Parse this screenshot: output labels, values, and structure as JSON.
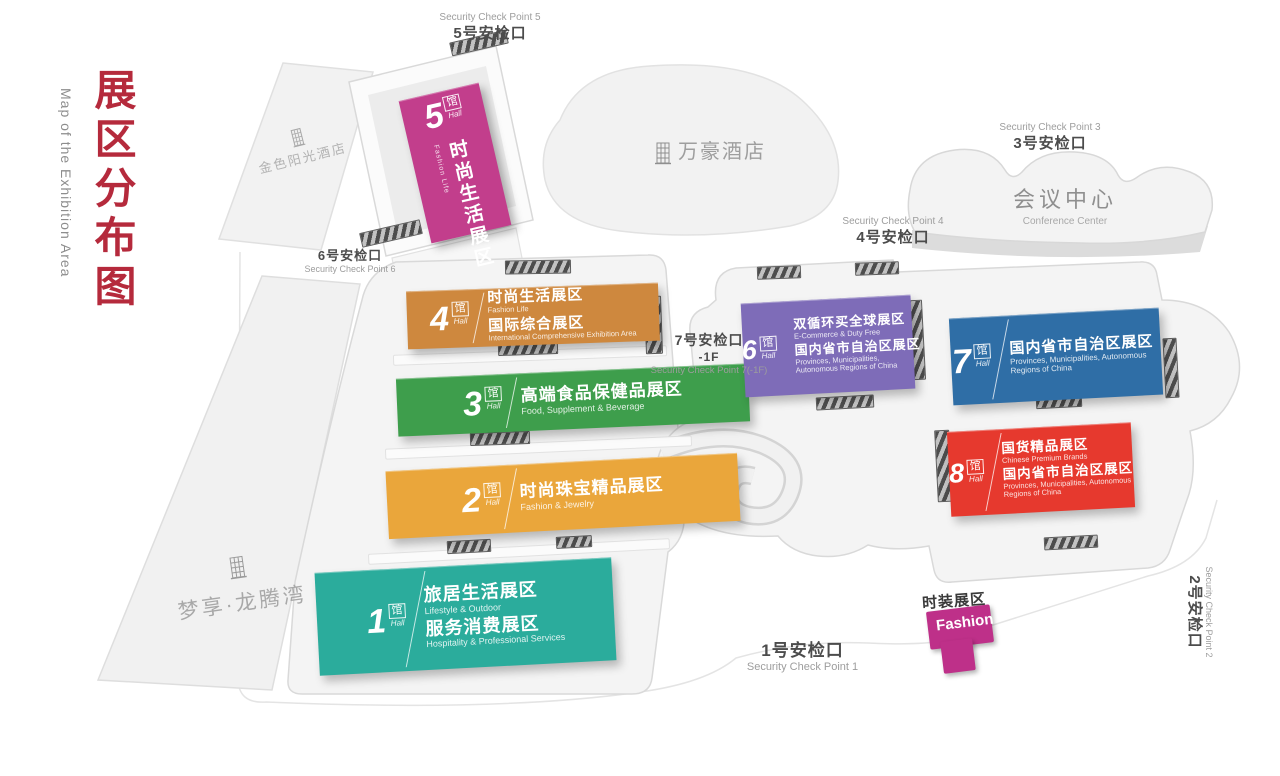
{
  "title": {
    "zh": "展区分布图",
    "en": "Map of the Exhibition Area"
  },
  "colors": {
    "title_red": "#B52A3C"
  },
  "buildings": {
    "golden_sun": {
      "label": "金色阳光酒店"
    },
    "marriott": {
      "label": "万豪酒店"
    },
    "mengxiang": {
      "label": "梦享·龙腾湾"
    },
    "conference": {
      "zh": "会议中心",
      "en": "Conference Center"
    }
  },
  "checkpoints": {
    "cp1": {
      "zh": "1号安检口",
      "en": "Security Check Point 1"
    },
    "cp2": {
      "zh": "2号安检口",
      "en": "Security Check Point 2"
    },
    "cp3": {
      "zh": "3号安检口",
      "en": "Security Check Point 3"
    },
    "cp4": {
      "zh": "4号安检口",
      "en": "Security Check Point 4"
    },
    "cp5": {
      "zh": "5号安检口",
      "en": "Security Check Point 5"
    },
    "cp6": {
      "zh": "6号安检口",
      "en": "Security Check Point 6"
    },
    "cp7": {
      "zh": "7号安检口",
      "floor": "-1F",
      "en": "Security Check Point 7(-1F)"
    }
  },
  "halls": {
    "h1": {
      "num": "1",
      "unit": "馆",
      "unit_en": "Hall",
      "color": "#2BAC9C",
      "zh1": "旅居生活展区",
      "en1": "Lifestyle & Outdoor",
      "zh2": "服务消费展区",
      "en2": "Hospitality & Professional Services"
    },
    "h2": {
      "num": "2",
      "unit": "馆",
      "unit_en": "Hall",
      "color": "#EAA63B",
      "zh1": "时尚珠宝精品展区",
      "en1": "Fashion & Jewelry"
    },
    "h3": {
      "num": "3",
      "unit": "馆",
      "unit_en": "Hall",
      "color": "#3E9E4C",
      "zh1": "高端食品保健品展区",
      "en1": "Food, Supplement & Beverage"
    },
    "h4": {
      "num": "4",
      "unit": "馆",
      "unit_en": "Hall",
      "color": "#CE883E",
      "zh1": "时尚生活展区",
      "en1": "Fashion Life",
      "zh2": "国际综合展区",
      "en2": "International Comprehensive Exhibition Area"
    },
    "h5": {
      "num": "5",
      "unit": "馆",
      "unit_en": "Hall",
      "color": "#C23E8C",
      "zh1": "时尚生活展区",
      "en1": "Fashion Life"
    },
    "h6": {
      "num": "6",
      "unit": "馆",
      "unit_en": "Hall",
      "color": "#7E6CB8",
      "zh1": "双循环买全球展区",
      "en1": "E-Commerce & Duty Free",
      "zh2": "国内省市自治区展区",
      "en2": "Provinces, Municipalities, Autonomous Regions of China"
    },
    "h7": {
      "num": "7",
      "unit": "馆",
      "unit_en": "Hall",
      "color": "#2F6EA6",
      "zh1": "国内省市自治区展区",
      "en1": "Provinces, Municipalities, Autonomous Regions of China"
    },
    "h8": {
      "num": "8",
      "unit": "馆",
      "unit_en": "Hall",
      "color": "#E6392E",
      "zh1": "国货精品展区",
      "en1": "Chinese Premium Brands",
      "zh2": "国内省市自治区展区",
      "en2": "Provinces, Municipalities, Autonomous Regions of China"
    }
  },
  "fashion": {
    "zh": "时装展区",
    "en": "Fashion",
    "color": "#BE3089"
  }
}
